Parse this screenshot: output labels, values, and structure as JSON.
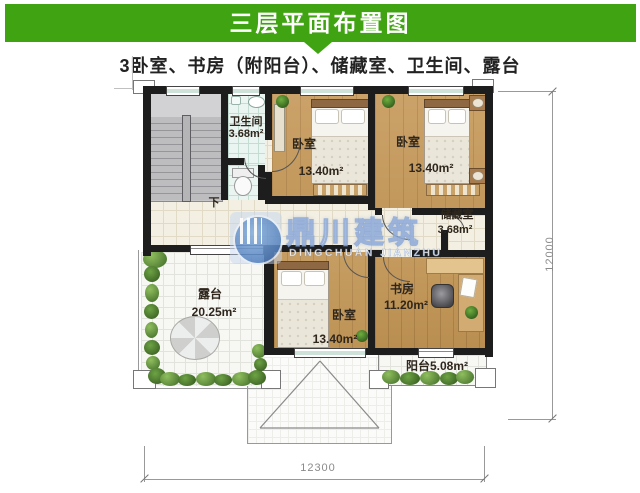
{
  "header": {
    "title": "三层平面布置图",
    "subtitle": "3卧室、书房（附阳台）、储藏室、卫生间、露台"
  },
  "plan": {
    "rooms": {
      "bathroom": {
        "name": "卫生间",
        "area": "3.68m²"
      },
      "bedroom_top_left": {
        "name": "卧室",
        "area": "13.40m²"
      },
      "bedroom_top_right": {
        "name": "卧室",
        "area": "13.40m²"
      },
      "storage": {
        "name": "储藏室",
        "area": "3.68m²"
      },
      "bedroom_bottom": {
        "name": "卧室",
        "area": "13.40m²"
      },
      "study": {
        "name": "书房",
        "area": "11.20m²"
      },
      "terrace": {
        "name": "露台",
        "area": "20.25m²"
      },
      "balcony": {
        "label": "阳台5.08m²"
      }
    },
    "stairs": {
      "down_label": "下"
    },
    "dimensions": {
      "width": "12300",
      "height": "12000"
    }
  },
  "watermark": {
    "cn": "鼎川建筑",
    "en": "DINGCHUAN JIANZHU"
  },
  "colors": {
    "banner_green": "#40a412",
    "wall_black": "#1d1d1d",
    "wood_floor": "#c9a066",
    "watermark_blue": "#4d7fc0",
    "tile_cream": "#f3efe2",
    "greenery": "#588a38"
  }
}
